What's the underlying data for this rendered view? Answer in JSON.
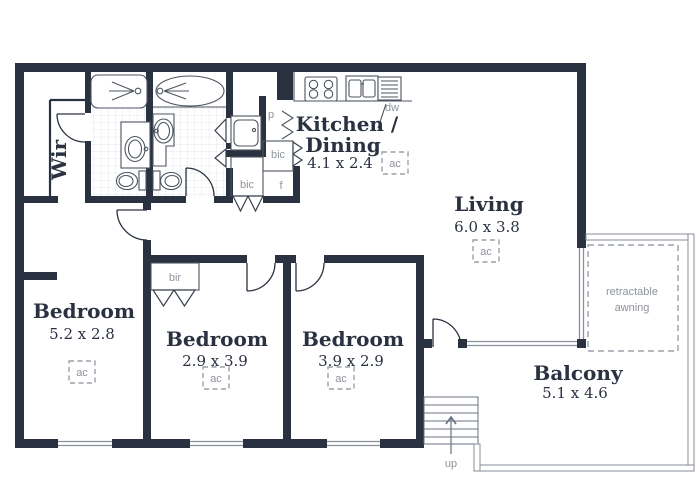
{
  "plan": {
    "rooms": [
      {
        "name": "Wir"
      },
      {
        "name": "Kitchen /",
        "name_line2": "Dining",
        "dims": "4.1 x 2.4"
      },
      {
        "name": "Living",
        "dims": "6.0 x 3.8"
      },
      {
        "name": "Bedroom",
        "dims": "5.2 x 2.8"
      },
      {
        "name": "Bedroom",
        "dims": "2.9 x 3.9"
      },
      {
        "name": "Bedroom",
        "dims": "3.9 x 2.9"
      },
      {
        "name": "Balcony",
        "dims": "5.1 x 4.6"
      }
    ],
    "annotations": {
      "ac": "ac",
      "pantry": "p",
      "built_in_cupboard": "bic",
      "fridge": "f",
      "built_in_robe": "bir",
      "dishwasher": "dw",
      "stairs_up": "up",
      "awning_line1": "retractable",
      "awning_line2": "awning"
    },
    "colors": {
      "wall": "#2a3140",
      "annotation_gray": "#8e939c",
      "railing_gray": "#878d96",
      "tile_gray": "#e4e7ea"
    }
  }
}
